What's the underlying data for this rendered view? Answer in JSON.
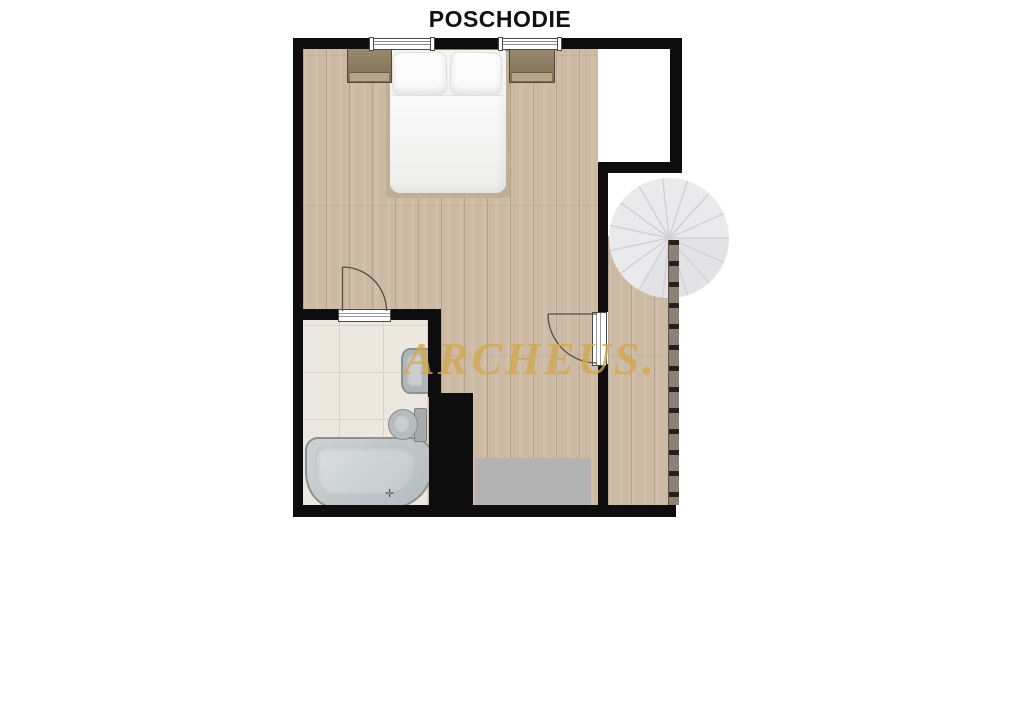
{
  "title": "POSCHODIE",
  "watermark": "ARCHEUS.",
  "rooms": [
    {
      "label": "IZBA"
    },
    {
      "label": "KÚPEĽŇA"
    }
  ],
  "fixtures": [
    "bed",
    "nightstand",
    "nightstand",
    "bathtub",
    "sink",
    "toilet",
    "spiral-staircase",
    "railing"
  ],
  "colors": {
    "wall": "#0d0d0d",
    "wood": "#cdbaa4",
    "tile": "#ece8e0",
    "grout": "#d9d3c6",
    "stair": "#eaeaec",
    "stair-line": "#d2d2d6",
    "railing": "#8b8275",
    "railing-post": "#26211c",
    "landing-gray": "#b3b3b3",
    "watermark-gold": "#d2a84e",
    "fixture-border": "#8a9094",
    "bed-frame": "#c0af97"
  }
}
